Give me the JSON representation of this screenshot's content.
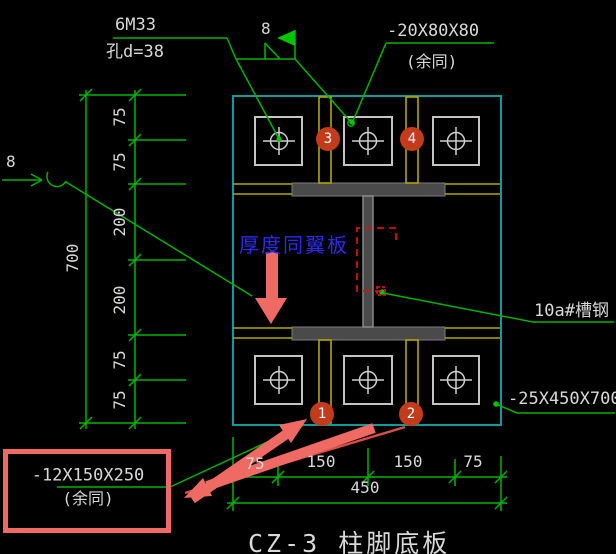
{
  "drawing_title": "CZ-3 柱脚底板",
  "labels": {
    "anchor_bolt_count": "6M33",
    "anchor_bolt_hole": "孔d=38",
    "weld_size_top": "8",
    "weld_size_left": "8",
    "washer_plate_size": "-20X80X80",
    "washer_plate_note": "(余同)",
    "web_thickness_note": "厚度同翼板",
    "channel_steel": "10a#槽钢",
    "base_plate_size": "-25X450X700",
    "stiffener_plate_size": "-12X150X250",
    "stiffener_plate_note": "(余同)"
  },
  "dimensions": {
    "left": [
      "75",
      "75",
      "200",
      "200",
      "75",
      "75"
    ],
    "left_total": "700",
    "bottom": [
      "75",
      "150",
      "150",
      "75"
    ],
    "bottom_total": "450"
  },
  "balloons": [
    "1",
    "2",
    "3",
    "4"
  ],
  "colors": {
    "background": "#000000",
    "line_green": "#00b300",
    "plate_cyan": "#0d9b9b",
    "stiffener_yellow": "#b3a600",
    "beam_gray": "#4a4a4a",
    "text_white": "#d9d9d9",
    "note_blue": "#2b2bf0",
    "balloon_red": "#c23c1c",
    "markup_salmon": "#ee6a62",
    "channel_dash_red": "#d41111"
  }
}
